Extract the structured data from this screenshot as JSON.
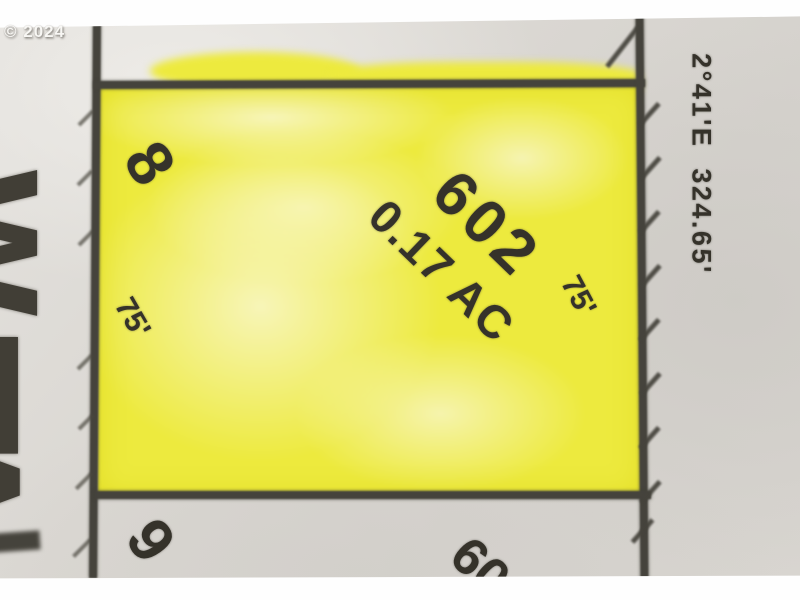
{
  "watermark": "© 2024",
  "highlighted_parcel": {
    "lot_number": "8",
    "parcel_number": "602",
    "area_label": "0.17 AC",
    "dimension_left": "75'",
    "dimension_right": "75'"
  },
  "adjacent_parcels": {
    "lot_below_number": "9",
    "parcel_below_partial_number": "60"
  },
  "right_boundary": {
    "bearing_distance_label": "2°41'E  324.65'"
  },
  "left_edge_partial_letters": [
    "W",
    "E",
    "A"
  ],
  "colors": {
    "highlight_yellow": "#edea3e",
    "highlight_pale_yellow": "#f8f6c6",
    "pencil_line": "#45433c",
    "map_text": "#35322a",
    "paper_light": "#e4e2de",
    "paper_dark": "#d5d2cd",
    "photo_border_white": "#fefefe"
  }
}
